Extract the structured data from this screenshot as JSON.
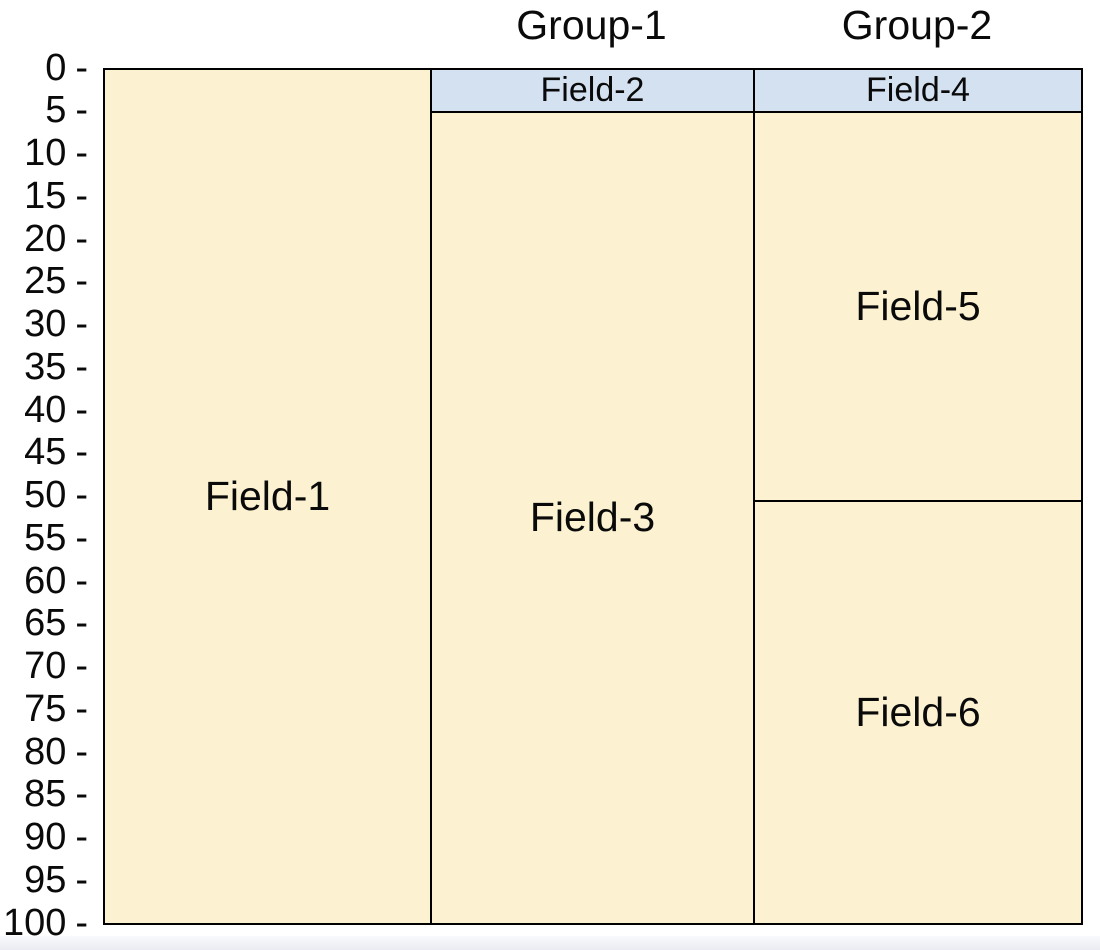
{
  "page": {
    "background": "#ffffff",
    "footer_strip_color": "#e9ecf2"
  },
  "chart_data": {
    "type": "bar",
    "variant": "grouped depth-section columns (stacked boxes against a 0-100 depth axis)",
    "title": "",
    "xlabel": "",
    "ylabel": "",
    "legend": "none",
    "grid": "off",
    "y_axis": {
      "min": 0,
      "max": 100,
      "tick_step": 5,
      "tick_labels": [
        "0",
        "5",
        "10",
        "15",
        "20",
        "25",
        "30",
        "35",
        "40",
        "45",
        "50",
        "55",
        "60",
        "65",
        "70",
        "75",
        "80",
        "85",
        "90",
        "95",
        "100"
      ],
      "tick_suffix": "-"
    },
    "colors": {
      "field_fill": "#fcf2d1",
      "header_fill": "#d4e1f0",
      "border": "#000000",
      "text": "#0a0a0a"
    },
    "group_labels": [
      "Group-1",
      "Group-2"
    ],
    "columns": [
      {
        "group": "",
        "fields": [
          {
            "name": "Field-1",
            "top": 0,
            "bottom": 100,
            "role": "field"
          }
        ]
      },
      {
        "group": "Group-1",
        "fields": [
          {
            "name": "Field-2",
            "top": 0,
            "bottom": 5,
            "role": "header"
          },
          {
            "name": "Field-3",
            "top": 5,
            "bottom": 100,
            "role": "field"
          }
        ]
      },
      {
        "group": "Group-2",
        "fields": [
          {
            "name": "Field-4",
            "top": 0,
            "bottom": 5,
            "role": "header"
          },
          {
            "name": "Field-5",
            "top": 5,
            "bottom": 50.5,
            "role": "field"
          },
          {
            "name": "Field-6",
            "top": 50.5,
            "bottom": 100,
            "role": "field"
          }
        ]
      }
    ]
  }
}
